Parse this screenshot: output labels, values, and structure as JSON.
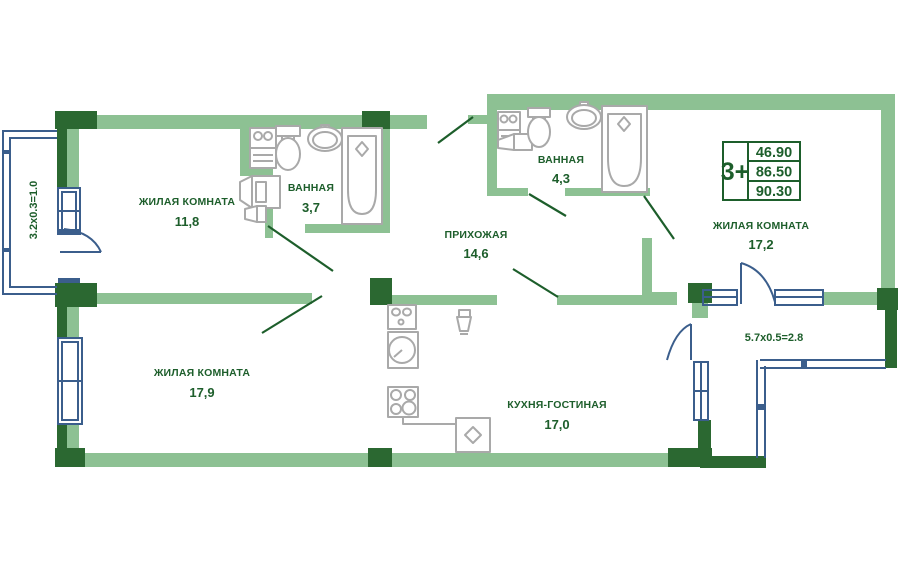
{
  "palette": {
    "bg": "#ffffff",
    "wall_light": "#8dc193",
    "wall_dark": "#2b6831",
    "text_green": "#1d5e2b",
    "line_blue": "#3b5e8c",
    "fixture_gray": "#a9a9a9"
  },
  "legend": {
    "type_label": "3+",
    "values": [
      "46.90",
      "86.50",
      "90.30"
    ]
  },
  "rooms": {
    "living1": {
      "label": "ЖИЛАЯ КОМНАТА",
      "area": "11,8"
    },
    "bath1": {
      "label": "ВАННАЯ",
      "area": "3,7"
    },
    "hall": {
      "label": "ПРИХОЖАЯ",
      "area": "14,6"
    },
    "bath2": {
      "label": "ВАННАЯ",
      "area": "4,3"
    },
    "living2": {
      "label": "ЖИЛАЯ КОМНАТА",
      "area": "17,2"
    },
    "living3": {
      "label": "ЖИЛАЯ КОМНАТА",
      "area": "17,9"
    },
    "kitchen": {
      "label": "КУХНЯ-ГОСТИНАЯ",
      "area": "17,0"
    }
  },
  "balconies": {
    "left": {
      "dimensions": "3.2х0.3=1.0"
    },
    "right": {
      "dimensions": "5.7х0.5=2.8"
    }
  }
}
